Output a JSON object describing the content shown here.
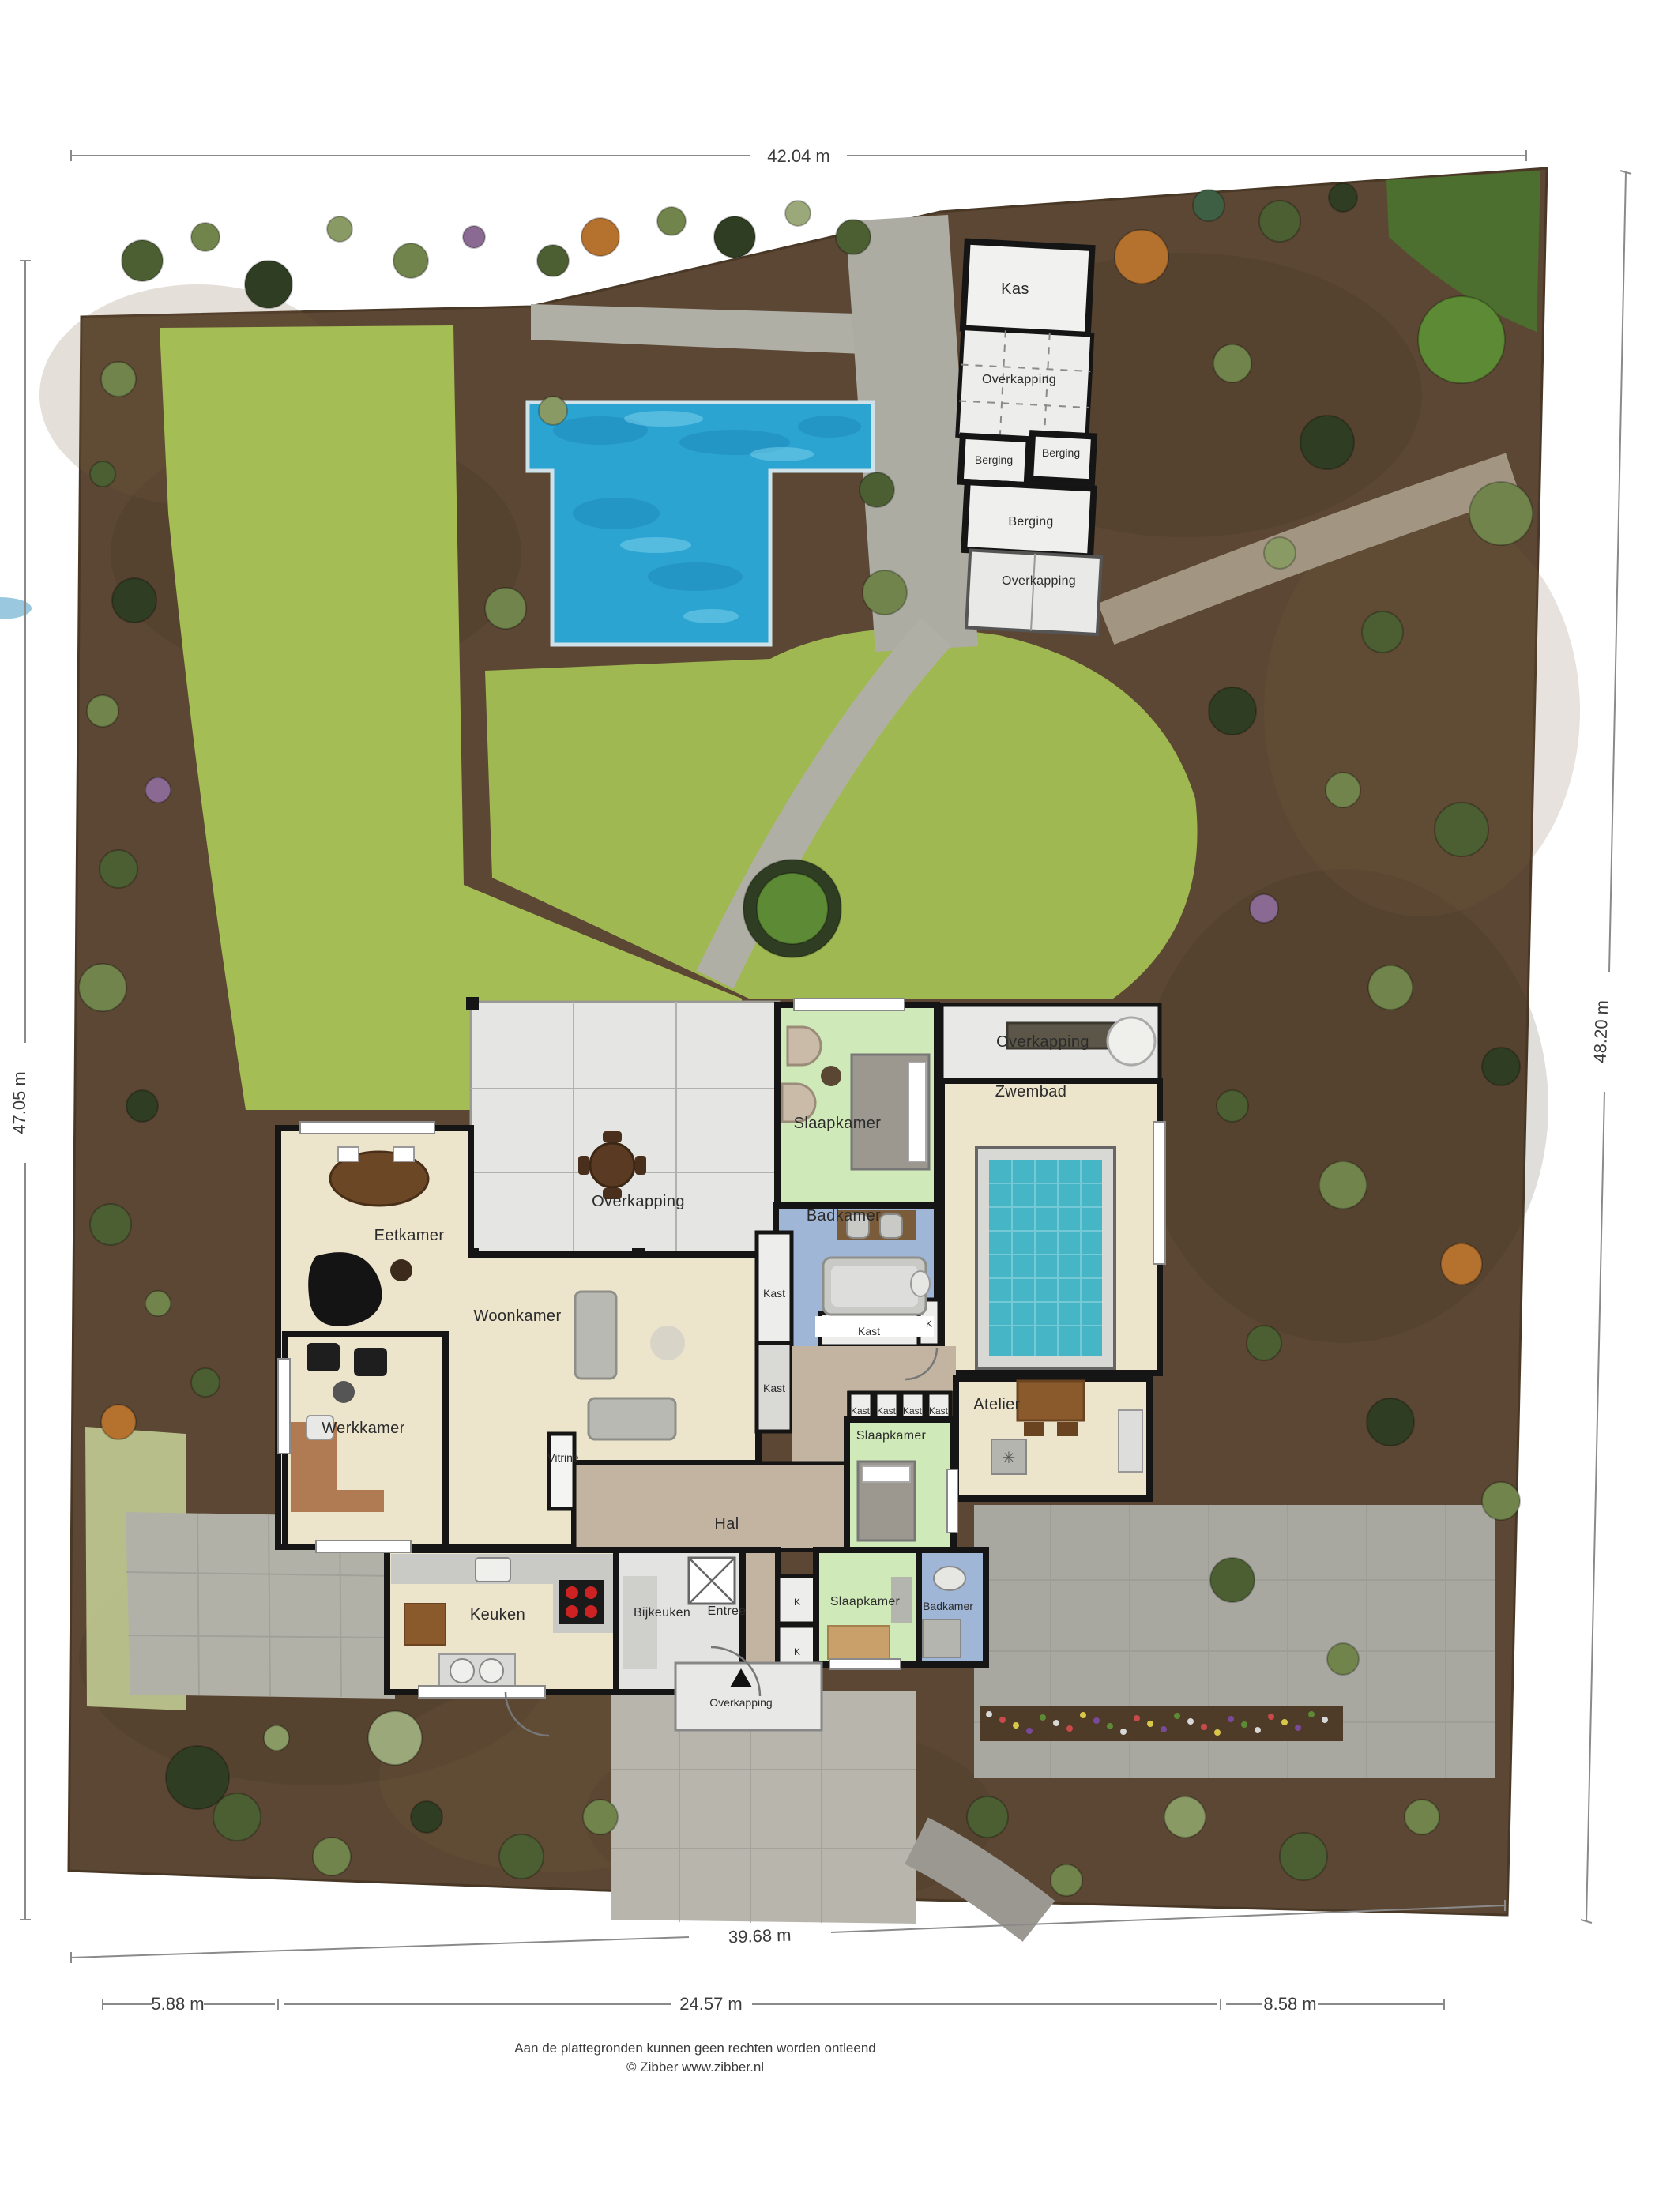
{
  "plan": {
    "dimensions": {
      "top": "42.04 m",
      "left": "47.05 m",
      "right": "48.20 m",
      "bottom": "39.68 m",
      "bottom_segments": [
        "5.88 m",
        "24.57 m",
        "8.58 m"
      ]
    },
    "outbuildings": {
      "kas": "Kas",
      "overkapping_1": "Overkapping",
      "berging_1": "Berging",
      "berging_2": "Berging",
      "berging_3": "Berging",
      "overkapping_2": "Overkapping"
    },
    "rooms": {
      "slaapkamer_top": "Slaapkamer",
      "overkapping_pool": "Overkapping",
      "zwembad": "Zwembad",
      "badkamer_top": "Badkamer",
      "kast_1": "Kast",
      "kast_2": "Kast",
      "k_1": "K",
      "kast_3": "Kast",
      "eetkamer": "Eetkamer",
      "overkapping_terras": "Overkapping",
      "woonkamer": "Woonkamer",
      "werkkamer": "Werkkamer",
      "vitrine": "Vitrine",
      "kast_row": [
        "Kast",
        "Kast",
        "Kast",
        "Kast"
      ],
      "slaapkamer_mid": "Slaapkamer",
      "atelier": "Atelier",
      "hal": "Hal",
      "keuken": "Keuken",
      "bijkeuken": "Bijkeuken",
      "entree": "Entree",
      "k_2": "K",
      "k_3": "K",
      "slaapkamer_bot": "Slaapkamer",
      "badkamer_bot": "Badkamer",
      "overkapping_entree": "Overkapping"
    },
    "footer": {
      "line1": "Aan de plattegronden kunnen geen rechten worden ontleend",
      "line2": "© Zibber www.zibber.nl"
    },
    "colors": {
      "soil": "#5b4733",
      "lawn": "#a5bd55",
      "pool_water": "#2ba4d2",
      "zwembad_tile": "#46b6c6",
      "room_cream": "#ece4cb",
      "room_green": "#cfe9b8",
      "room_blue": "#a0b6d7",
      "hall_tan": "#c3b4a1",
      "terrace_gray": "#e6e6e4",
      "wall": "#151515"
    }
  }
}
